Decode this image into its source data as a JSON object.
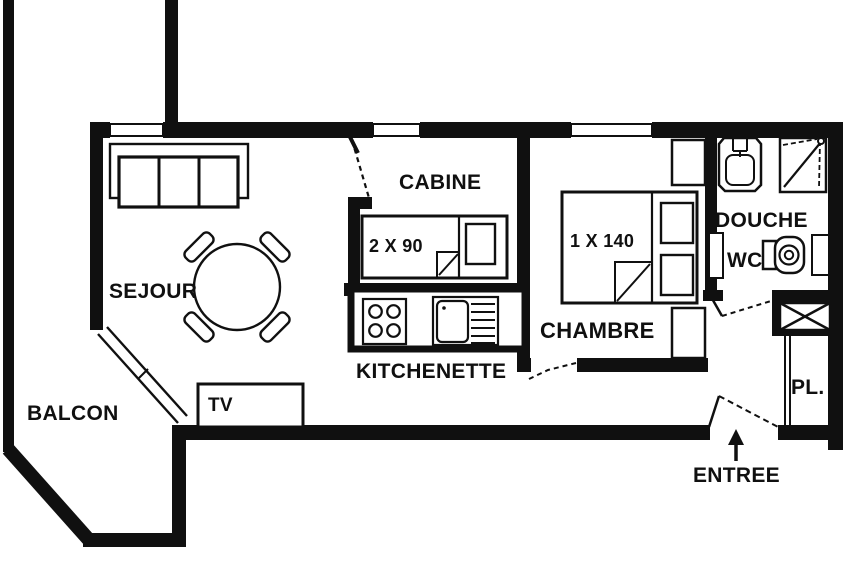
{
  "floor_plan": {
    "title": "apartment-floor-plan",
    "colors": {
      "wall": "#101010",
      "background": "#ffffff"
    },
    "rooms": {
      "balcon": {
        "label": "BALCON"
      },
      "sejour": {
        "label": "SEJOUR"
      },
      "cabine": {
        "label": "CABINE"
      },
      "kitchenette": {
        "label": "KITCHENETTE"
      },
      "chambre": {
        "label": "CHAMBRE"
      },
      "douche": {
        "label": "DOUCHE"
      },
      "wc": {
        "label": "WC"
      },
      "placard": {
        "label": "PL."
      },
      "entree": {
        "label": "ENTREE"
      }
    },
    "furniture": {
      "tv": {
        "label": "TV"
      },
      "cabine_bed": {
        "label": "2 X 90"
      },
      "chambre_bed": {
        "label": "1 X 140"
      }
    }
  }
}
